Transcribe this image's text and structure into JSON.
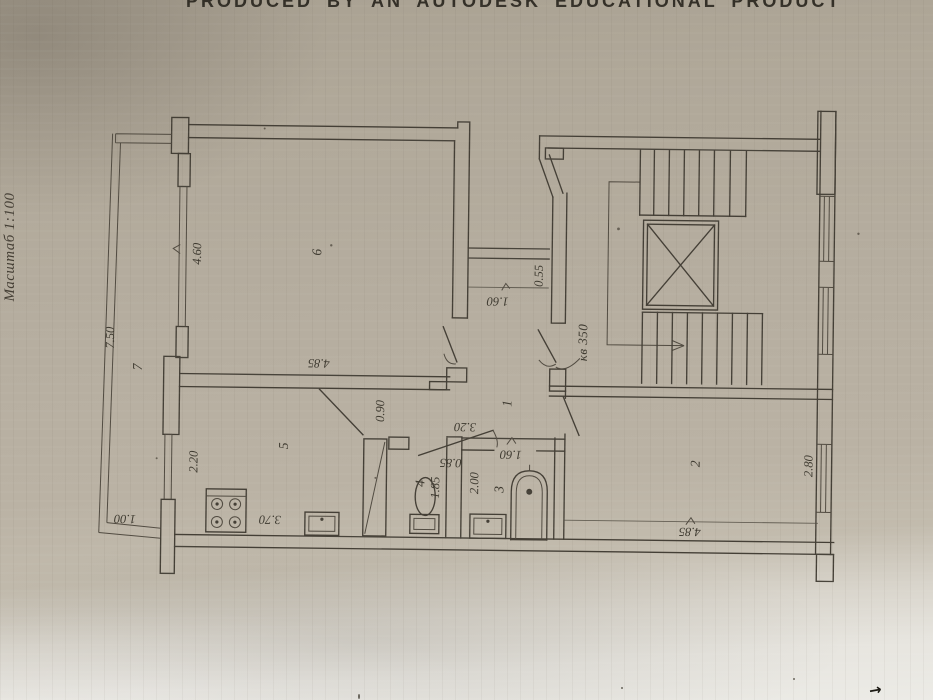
{
  "photo": {
    "header_text": "PRODUCED BY AN AUTODESK EDUCATIONAL PRODUCT",
    "scale_label": "Масштаб 1:100",
    "bottom_arrow_mark": "→"
  },
  "plan": {
    "apartment_label": "кв 350",
    "rooms": {
      "hall": "1",
      "living_room": "2",
      "bathroom": "3",
      "wc": "4",
      "kitchen": "5",
      "bedroom": "6",
      "balcony": "7"
    },
    "dims": {
      "d055": "0.55",
      "d085": "0.85",
      "d090": "0.90",
      "d100": "1.00",
      "d160_bath": "1.60",
      "d160_vestibule": "1.60",
      "d185": "1.85",
      "d200": "2.00",
      "d220": "2.20",
      "d280": "2.80",
      "d320": "3.20",
      "d370": "3.70",
      "d460": "4.60",
      "d485_bedroom": "4.85",
      "d485_living": "4.85",
      "d750": "7.50"
    }
  },
  "colors": {
    "paper": "#b5ad9f",
    "paper_light": "#ecebe6",
    "ink": "#443f36",
    "header_ink": "#332f27"
  }
}
